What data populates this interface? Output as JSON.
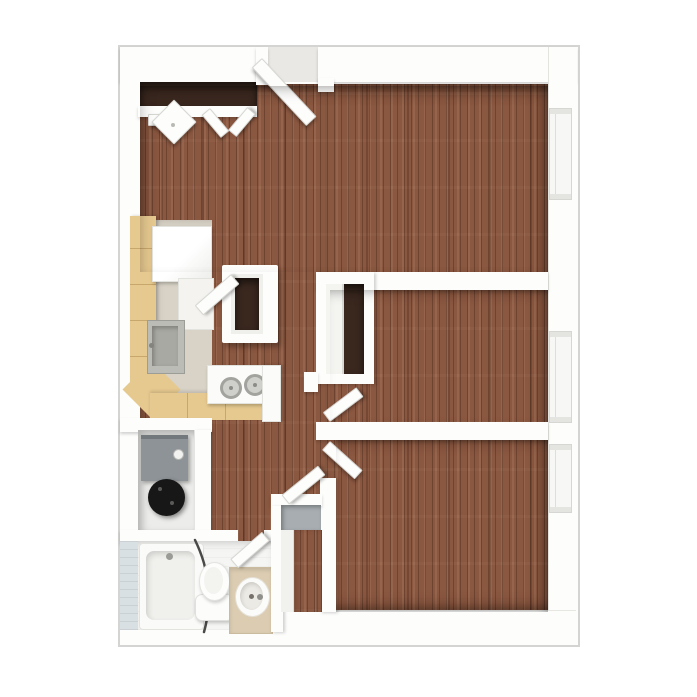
{
  "scene": {
    "type": "3d-top-down-floor-plan",
    "rooms": [
      "living-room",
      "kitchen",
      "hallway",
      "bedroom-1",
      "bedroom-2",
      "bathroom",
      "utility-closet",
      "entry-closet",
      "hall-closet"
    ],
    "fixtures": [
      "entry-door",
      "bifold-closet-doors",
      "refrigerator",
      "kitchen-sink",
      "stove",
      "pass-through-doorway",
      "bedroom-1-closet",
      "bedroom-1-door",
      "bedroom-2-door",
      "furnace",
      "water-heater",
      "bathtub",
      "shower-curtain-rod",
      "toilet",
      "vanity-sink",
      "hall-closet-shelf",
      "window-living-room",
      "window-bedroom-1",
      "window-bedroom-2"
    ]
  },
  "palette": {
    "background": "#ffffff",
    "wall": "#fdfdfc",
    "outline": "#d4d4d2",
    "wood_floor": "#8a5740",
    "closet_dark": "#3a281f",
    "kitchen_floor": "#d9d3c7",
    "counter": "#e6c98f",
    "counter_edge": "#c8a76c",
    "appliance_white": "#fbfbfa",
    "sink_gray": "#bcbcb6",
    "sink_gray_dark": "#a9a9a3",
    "utility_floor": "#ececea",
    "furnace_gray": "#8e9397",
    "water_heater_black": "#171717",
    "bathroom_floor": "#f5f5f3",
    "bathroom_wall_tile": "#d9e0e4",
    "vanity_tan": "#dccdb2",
    "shelf_gray": "#a7adb0",
    "window_glass": "#f7f7f6",
    "threshold": "#eae8e4",
    "rod_dark": "#4a4a48"
  }
}
